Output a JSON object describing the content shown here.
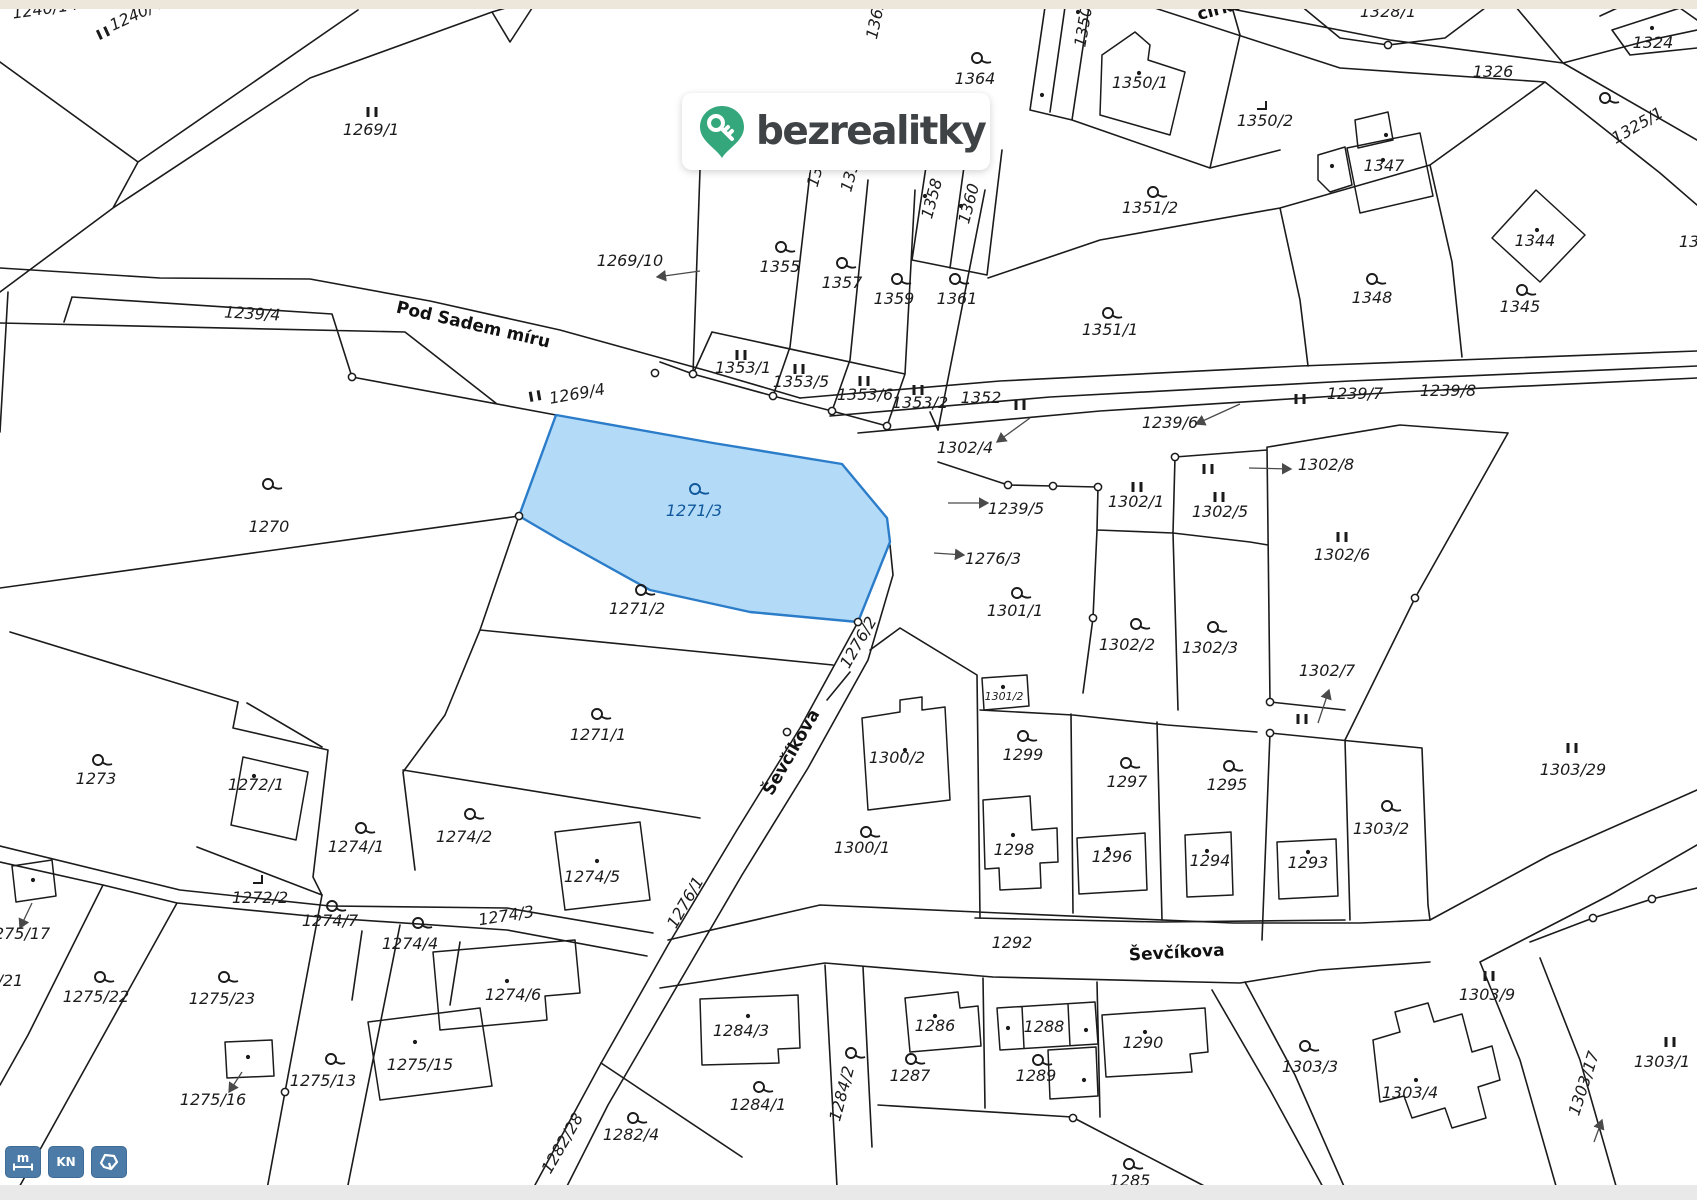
{
  "logo": {
    "text": "bezrealitky",
    "pin_color": "#35a77c",
    "text_color": "#3f4346"
  },
  "toolbar": {
    "color": "#4d7ba7",
    "buttons": [
      {
        "name": "measure-button",
        "label": "m",
        "icon": "ruler-icon"
      },
      {
        "name": "kn-button",
        "label": "KN",
        "icon": ""
      },
      {
        "name": "parcel-shape-button",
        "label": "",
        "icon": "parcel-polygon-icon"
      }
    ]
  },
  "map": {
    "highlight": {
      "parcel": "1271/3",
      "fill": "#abd7f7",
      "stroke": "#2b7cc9",
      "label_color": "#10589b"
    },
    "street_labels": [
      {
        "t": "Pod Sadem míru",
        "x": 472,
        "y": 330,
        "r": 13
      },
      {
        "t": "Ševčíkova",
        "x": 796,
        "y": 755,
        "r": -60
      },
      {
        "t": "Ševčíkova",
        "x": 1177,
        "y": 958,
        "r": -3
      },
      {
        "t": "círku",
        "x": 1222,
        "y": 14,
        "r": -15
      }
    ],
    "parcel_labels": [
      {
        "t": "1240/14",
        "x": 46,
        "y": 14,
        "r": -8
      },
      {
        "t": "1240/45",
        "x": 143,
        "y": 17,
        "r": -25
      },
      {
        "t": "1269/1",
        "x": 371,
        "y": 135
      },
      {
        "t": "1269/10",
        "x": 630,
        "y": 266
      },
      {
        "t": "1269/4",
        "x": 578,
        "y": 399,
        "r": -10
      },
      {
        "t": "1239/4",
        "x": 252,
        "y": 319,
        "r": 3
      },
      {
        "t": "1362",
        "x": 881,
        "y": 20,
        "r": -78
      },
      {
        "t": "1364",
        "x": 975,
        "y": 84
      },
      {
        "t": "1355",
        "x": 780,
        "y": 272
      },
      {
        "t": "1357",
        "x": 842,
        "y": 288
      },
      {
        "t": "1359",
        "x": 894,
        "y": 304
      },
      {
        "t": "1361",
        "x": 957,
        "y": 304
      },
      {
        "t": "1358",
        "x": 937,
        "y": 200,
        "r": -75
      },
      {
        "t": "1360",
        "x": 974,
        "y": 205,
        "r": -75
      },
      {
        "t": "13",
        "x": 820,
        "y": 178,
        "r": -75
      },
      {
        "t": "135",
        "x": 855,
        "y": 178,
        "r": -75
      },
      {
        "t": "1353/1",
        "x": 743,
        "y": 373
      },
      {
        "t": "1353/5",
        "x": 801,
        "y": 387
      },
      {
        "t": "1353/6",
        "x": 865,
        "y": 400
      },
      {
        "t": "1353/2",
        "x": 920,
        "y": 408
      },
      {
        "t": "1352",
        "x": 981,
        "y": 403
      },
      {
        "t": "1351/1",
        "x": 1110,
        "y": 335
      },
      {
        "t": "1351/2",
        "x": 1150,
        "y": 213
      },
      {
        "t": "1350/1",
        "x": 1140,
        "y": 88
      },
      {
        "t": "1350/2",
        "x": 1265,
        "y": 126
      },
      {
        "t": "1350/3",
        "x": 1090,
        "y": 20,
        "r": -80
      },
      {
        "t": "1328/1",
        "x": 1388,
        "y": 17
      },
      {
        "t": "1322",
        "x": 1588,
        "y": 8
      },
      {
        "t": "1324",
        "x": 1653,
        "y": 48
      },
      {
        "t": "1326",
        "x": 1493,
        "y": 77
      },
      {
        "t": "1325/1",
        "x": 1640,
        "y": 130,
        "r": -30
      },
      {
        "t": "1347",
        "x": 1384,
        "y": 171
      },
      {
        "t": "1344",
        "x": 1535,
        "y": 246
      },
      {
        "t": "1348",
        "x": 1372,
        "y": 303
      },
      {
        "t": "1345",
        "x": 1520,
        "y": 312
      },
      {
        "t": "13",
        "x": 1689,
        "y": 247
      },
      {
        "t": "1239/6",
        "x": 1170,
        "y": 428
      },
      {
        "t": "1239/7",
        "x": 1355,
        "y": 399
      },
      {
        "t": "1239/8",
        "x": 1448,
        "y": 396
      },
      {
        "t": "1302/4",
        "x": 965,
        "y": 453
      },
      {
        "t": "1302/8",
        "x": 1326,
        "y": 470
      },
      {
        "t": "1302/1",
        "x": 1136,
        "y": 507
      },
      {
        "t": "1302/5",
        "x": 1220,
        "y": 517
      },
      {
        "t": "1302/6",
        "x": 1342,
        "y": 560
      },
      {
        "t": "1302/7",
        "x": 1327,
        "y": 676
      },
      {
        "t": "1302/2",
        "x": 1127,
        "y": 650
      },
      {
        "t": "1302/3",
        "x": 1210,
        "y": 653
      },
      {
        "t": "1239/5",
        "x": 1016,
        "y": 514
      },
      {
        "t": "1276/3",
        "x": 993,
        "y": 564
      },
      {
        "t": "1301/1",
        "x": 1015,
        "y": 616
      },
      {
        "t": "1301/2",
        "x": 1004,
        "y": 700,
        "c": "small"
      },
      {
        "t": "1276/2",
        "x": 863,
        "y": 645,
        "r": -60
      },
      {
        "t": "1303/29",
        "x": 1573,
        "y": 775
      },
      {
        "t": "1271/3",
        "x": 694,
        "y": 516,
        "c": "blue"
      },
      {
        "t": "1270",
        "x": 269,
        "y": 532
      },
      {
        "t": "1271/2",
        "x": 637,
        "y": 614
      },
      {
        "t": "1271/1",
        "x": 598,
        "y": 740
      },
      {
        "t": "1300/2",
        "x": 897,
        "y": 763
      },
      {
        "t": "1300/1",
        "x": 862,
        "y": 853
      },
      {
        "t": "1299",
        "x": 1023,
        "y": 760
      },
      {
        "t": "1297",
        "x": 1127,
        "y": 787
      },
      {
        "t": "1295",
        "x": 1227,
        "y": 790
      },
      {
        "t": "1298",
        "x": 1014,
        "y": 855
      },
      {
        "t": "1296",
        "x": 1112,
        "y": 862
      },
      {
        "t": "1294",
        "x": 1210,
        "y": 866
      },
      {
        "t": "1293",
        "x": 1308,
        "y": 868
      },
      {
        "t": "1303/2",
        "x": 1381,
        "y": 834
      },
      {
        "t": "1292",
        "x": 1012,
        "y": 948
      },
      {
        "t": "1286",
        "x": 935,
        "y": 1031
      },
      {
        "t": "1287",
        "x": 910,
        "y": 1081
      },
      {
        "t": "1288",
        "x": 1044,
        "y": 1032
      },
      {
        "t": "1289",
        "x": 1036,
        "y": 1081
      },
      {
        "t": "1290",
        "x": 1143,
        "y": 1048
      },
      {
        "t": "1285",
        "x": 1130,
        "y": 1186
      },
      {
        "t": "1284/3",
        "x": 741,
        "y": 1036
      },
      {
        "t": "1284/1",
        "x": 758,
        "y": 1110
      },
      {
        "t": "1284/2",
        "x": 847,
        "y": 1095,
        "r": -75
      },
      {
        "t": "1282/4",
        "x": 631,
        "y": 1140
      },
      {
        "t": "1282/28",
        "x": 567,
        "y": 1146,
        "r": -60
      },
      {
        "t": "1276/1",
        "x": 690,
        "y": 905,
        "r": -60
      },
      {
        "t": "1274/3",
        "x": 507,
        "y": 921,
        "r": -9
      },
      {
        "t": "1274/1",
        "x": 356,
        "y": 852
      },
      {
        "t": "1274/2",
        "x": 464,
        "y": 842
      },
      {
        "t": "1274/5",
        "x": 592,
        "y": 882
      },
      {
        "t": "1274/4",
        "x": 410,
        "y": 949
      },
      {
        "t": "1274/7",
        "x": 330,
        "y": 926
      },
      {
        "t": "1274/6",
        "x": 513,
        "y": 1000
      },
      {
        "t": "1272/1",
        "x": 256,
        "y": 790
      },
      {
        "t": "1272/2",
        "x": 260,
        "y": 903
      },
      {
        "t": "1273",
        "x": 96,
        "y": 784
      },
      {
        "t": "1275/17",
        "x": 17,
        "y": 939
      },
      {
        "t": "1275/21",
        "x": -10,
        "y": 986
      },
      {
        "t": "1275/22",
        "x": 96,
        "y": 1002
      },
      {
        "t": "1275/23",
        "x": 222,
        "y": 1004
      },
      {
        "t": "1275/13",
        "x": 323,
        "y": 1086
      },
      {
        "t": "1275/16",
        "x": 213,
        "y": 1105
      },
      {
        "t": "1275/15",
        "x": 420,
        "y": 1070
      },
      {
        "t": "1303/9",
        "x": 1487,
        "y": 1000
      },
      {
        "t": "1303/3",
        "x": 1310,
        "y": 1072
      },
      {
        "t": "1303/4",
        "x": 1410,
        "y": 1098
      },
      {
        "t": "1303/17",
        "x": 1589,
        "y": 1085,
        "r": -72
      },
      {
        "t": "1303/1",
        "x": 1662,
        "y": 1067
      }
    ],
    "symbols": {
      "flags": [
        [
          977,
          58
        ],
        [
          781,
          247
        ],
        [
          842,
          263
        ],
        [
          897,
          279
        ],
        [
          955,
          279
        ],
        [
          1108,
          313
        ],
        [
          1153,
          192
        ],
        [
          1605,
          98
        ],
        [
          1372,
          279
        ],
        [
          1522,
          290
        ],
        [
          268,
          484
        ],
        [
          641,
          590
        ],
        [
          597,
          714
        ],
        [
          1023,
          736
        ],
        [
          1126,
          763
        ],
        [
          1229,
          766
        ],
        [
          1136,
          624
        ],
        [
          1213,
          627
        ],
        [
          1017,
          593
        ],
        [
          866,
          832
        ],
        [
          1387,
          806
        ],
        [
          911,
          1059
        ],
        [
          1038,
          1060
        ],
        [
          1129,
          1164
        ],
        [
          759,
          1087
        ],
        [
          851,
          1053
        ],
        [
          633,
          1118
        ],
        [
          361,
          828
        ],
        [
          470,
          814
        ],
        [
          418,
          923
        ],
        [
          332,
          906
        ],
        [
          98,
          760
        ],
        [
          100,
          977
        ],
        [
          224,
          977
        ],
        [
          331,
          1059
        ],
        [
          1305,
          1046
        ]
      ],
      "blue_flag": [
        695,
        489
      ],
      "bars": [
        [
          372,
          112,
          0
        ],
        [
          103,
          33,
          -25
        ],
        [
          741,
          355,
          0
        ],
        [
          799,
          369,
          0
        ],
        [
          864,
          381,
          0
        ],
        [
          918,
          390,
          0
        ],
        [
          1020,
          405,
          0
        ],
        [
          535,
          396,
          -10
        ],
        [
          1137,
          487,
          0
        ],
        [
          1219,
          497,
          0
        ],
        [
          1208,
          469,
          0
        ],
        [
          1342,
          537,
          0
        ],
        [
          1302,
          719,
          0
        ],
        [
          1572,
          748,
          0
        ],
        [
          1489,
          976,
          0
        ],
        [
          1300,
          399,
          0
        ],
        [
          1670,
          1042,
          0
        ]
      ],
      "corners": [
        [
          1262,
          106
        ],
        [
          258,
          880
        ]
      ],
      "dots": [
        [
          1139,
          73
        ],
        [
          1652,
          28
        ],
        [
          1386,
          135
        ],
        [
          1383,
          160
        ],
        [
          1332,
          166
        ],
        [
          1537,
          230
        ],
        [
          925,
          196
        ],
        [
          961,
          206
        ],
        [
          1078,
          12
        ],
        [
          1042,
          95
        ],
        [
          254,
          776
        ],
        [
          597,
          861
        ],
        [
          507,
          981
        ],
        [
          415,
          1042
        ],
        [
          248,
          1057
        ],
        [
          33,
          880
        ],
        [
          748,
          1016
        ],
        [
          905,
          750
        ],
        [
          1003,
          687
        ],
        [
          1013,
          835
        ],
        [
          1108,
          849
        ],
        [
          1207,
          851
        ],
        [
          1308,
          852
        ],
        [
          935,
          1016
        ],
        [
          1008,
          1028
        ],
        [
          1086,
          1030
        ],
        [
          1084,
          1080
        ],
        [
          1145,
          1032
        ],
        [
          1416,
          1080
        ]
      ],
      "nodes": [
        [
          693,
          374
        ],
        [
          773,
          396
        ],
        [
          832,
          411
        ],
        [
          887,
          426
        ],
        [
          1008,
          485
        ],
        [
          1053,
          486
        ],
        [
          1098,
          487
        ],
        [
          1175,
          457
        ],
        [
          1093,
          618
        ],
        [
          1270,
          702
        ],
        [
          1270,
          733
        ],
        [
          1415,
          598
        ],
        [
          1593,
          918
        ],
        [
          1652,
          899
        ],
        [
          787,
          732
        ],
        [
          858,
          622
        ],
        [
          519,
          516
        ],
        [
          285,
          1092
        ],
        [
          1073,
          1118
        ],
        [
          1388,
          45
        ],
        [
          655,
          373
        ],
        [
          352,
          377
        ]
      ]
    }
  }
}
